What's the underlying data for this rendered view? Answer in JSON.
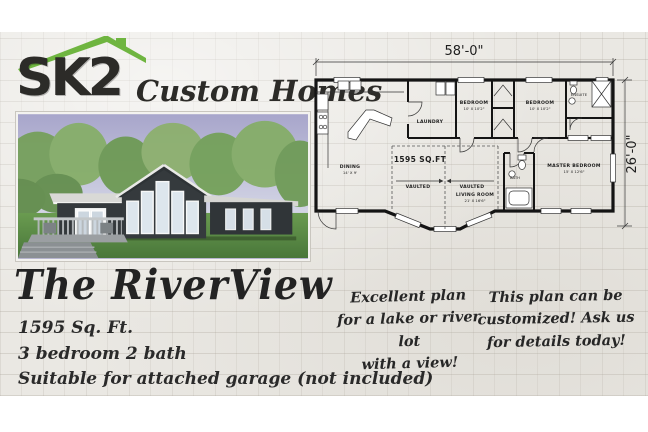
{
  "brand": {
    "name": "SK2",
    "tagline": "Custom Homes",
    "roof_color": "#6fb540",
    "text_color": "#2c2b28"
  },
  "plan": {
    "title": "The RiverView",
    "specs": [
      "1595 Sq. Ft.",
      "3 bedroom 2 bath",
      "Suitable for attached garage (not included)"
    ]
  },
  "notes": [
    {
      "lines": [
        "Excellent plan",
        "for a lake or river lot",
        "with a view!"
      ]
    },
    {
      "lines": [
        "This plan can be",
        "customized! Ask us",
        "for details today!"
      ]
    }
  ],
  "floorplan": {
    "width_label": "58'-0\"",
    "height_label": "26'-0\"",
    "sqft_label": "1595 SQ.FT",
    "vaulted_left": "VAULTED",
    "vaulted_right": "VAULTED",
    "rooms": {
      "dining": {
        "name": "DINING",
        "dims": "14' X 9'"
      },
      "living": {
        "name": "LIVING ROOM",
        "dims": "21' X 16'6\""
      },
      "laundry": {
        "name": "LAUNDRY"
      },
      "bedroom1": {
        "name": "BEDROOM",
        "dims": "10' X 10'2\""
      },
      "bedroom2": {
        "name": "BEDROOM",
        "dims": "10' X 10'2\""
      },
      "ensuite": {
        "name": "ENSUITE"
      },
      "bath": {
        "name": "BATH"
      },
      "master": {
        "name": "MASTER BEDROOM",
        "dims": "15' X 12'6\""
      }
    }
  }
}
